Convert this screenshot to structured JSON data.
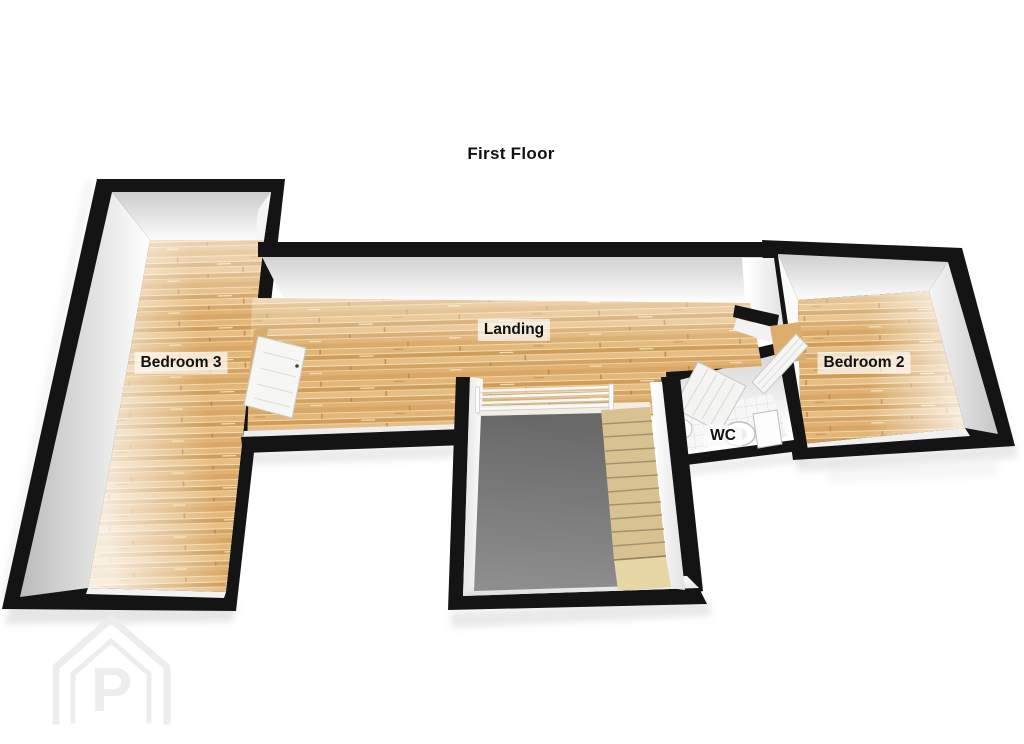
{
  "title": "First Floor",
  "rooms": [
    {
      "id": "bedroom-3",
      "label": "Bedroom 3"
    },
    {
      "id": "landing",
      "label": "Landing"
    },
    {
      "id": "wc",
      "label": "WC"
    },
    {
      "id": "bedroom-2",
      "label": "Bedroom 2"
    }
  ],
  "elements": {
    "staircase": "staircase-descending-from-landing",
    "banister": "stair-banister",
    "toilet": "toilet-icon",
    "basin": "hand-basin-icon",
    "doors": [
      "bedroom-3-open-door",
      "bedroom-2-open-door",
      "wc-open-door"
    ],
    "watermark": "house-logo-watermark"
  },
  "logo": {
    "letter": "P"
  },
  "colors": {
    "background": "#ffffff",
    "wall_black": "#141414",
    "wood_base": "#dcae6e",
    "wood_light": "#f1dcae",
    "wood_dark": "#c3914e",
    "stair_tread": "#d8c292",
    "stair_lower": "#e7d6a6",
    "void_dark": "#686868",
    "void_light": "#8f8f8f",
    "wall_face": "#ffffff",
    "reveal_shade": "#c9c9c9",
    "tile_floor": "#f7f7f7",
    "door_panel": "#f5f5f3",
    "label_text": "#111111",
    "label_bg": "rgba(255,255,255,0.66)",
    "watermark": "#ededed"
  }
}
